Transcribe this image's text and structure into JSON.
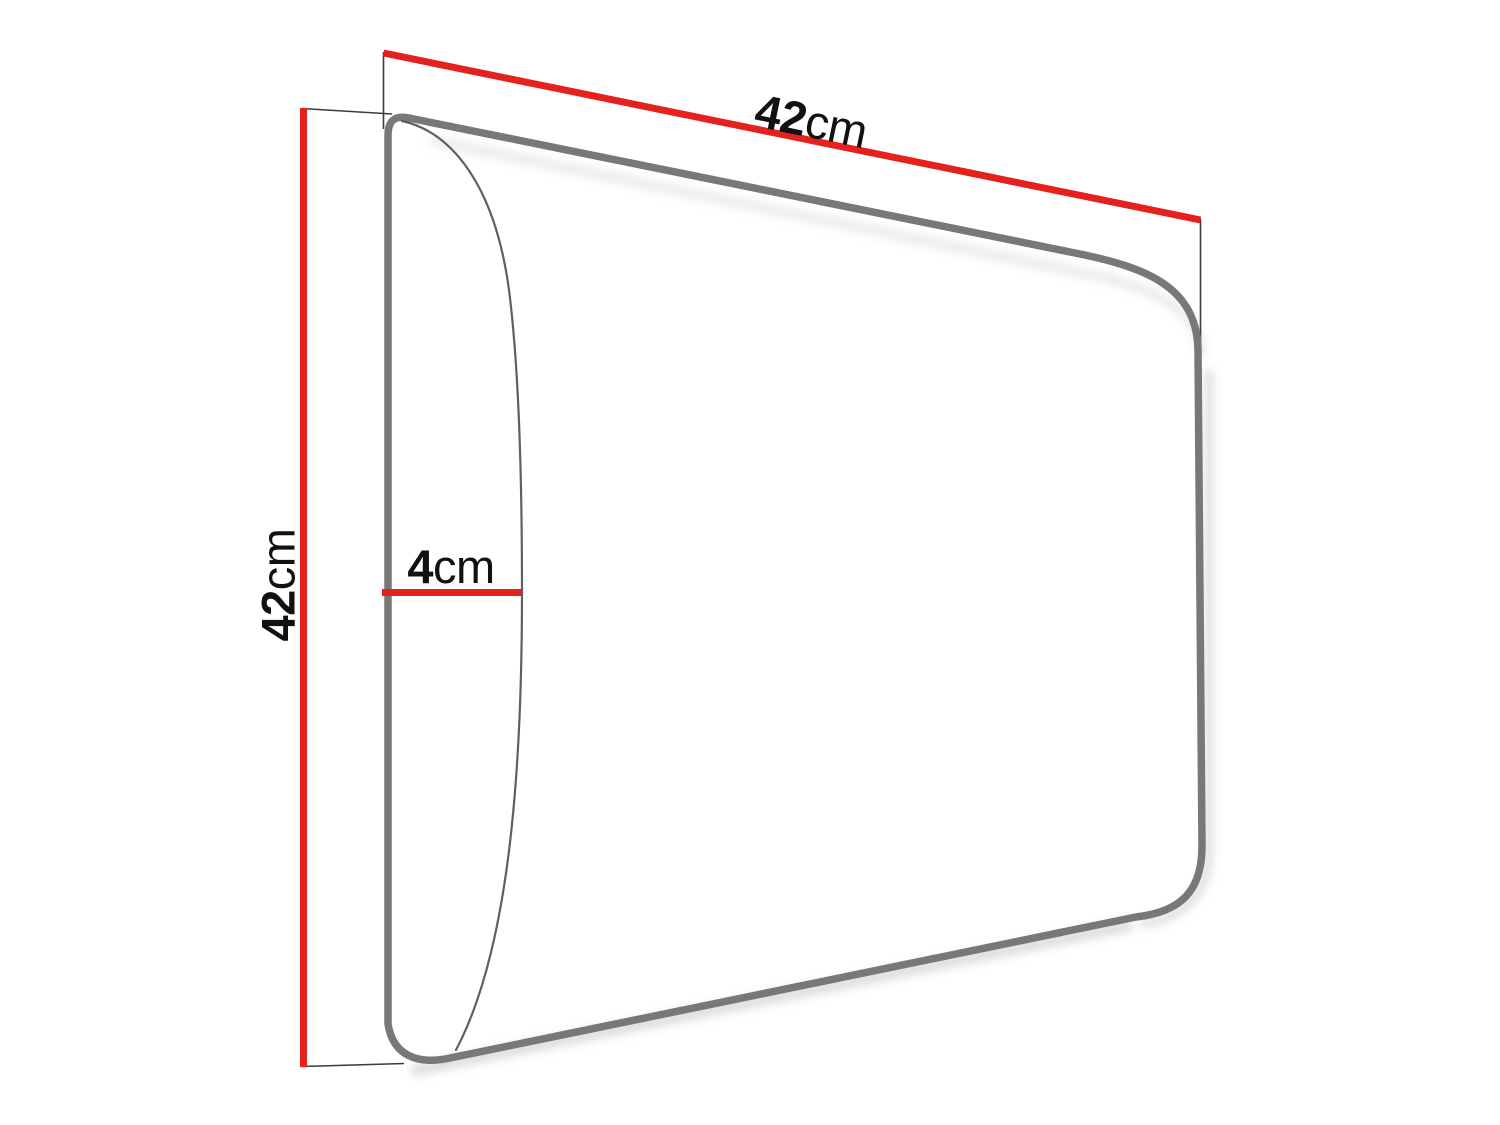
{
  "dimensions": {
    "width": {
      "value": "42",
      "unit": "cm"
    },
    "height": {
      "value": "42",
      "unit": "cm"
    },
    "thickness": {
      "value": "4",
      "unit": "cm"
    }
  },
  "colors": {
    "dimension_line": "#e4211c",
    "panel_outline": "#787878",
    "bulge_curve": "#606060",
    "extension_line": "#3c3c3c",
    "label_text": "#111111",
    "shadow": "#c0c0c0",
    "background": "#ffffff"
  }
}
